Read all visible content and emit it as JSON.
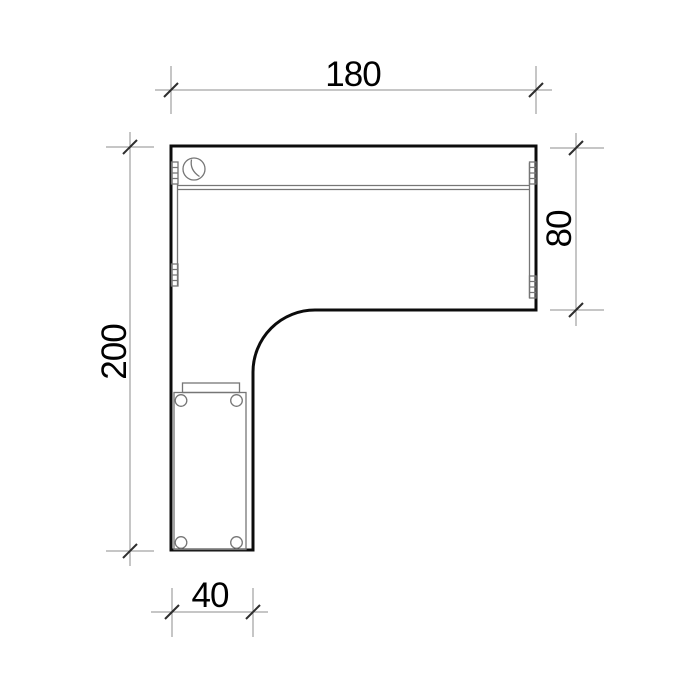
{
  "drawing": {
    "subject": "L-shaped corner desk, plan view technical drawing",
    "dimensions": {
      "top_width": {
        "value": "180"
      },
      "left_height": {
        "value": "200"
      },
      "right_depth": {
        "value": "80"
      },
      "bottom_width": {
        "value": "40"
      }
    },
    "colors": {
      "background": "#ffffff",
      "outline": "#0c0c0c",
      "detail_line": "#767676",
      "dimension_line": "#8e8e8e",
      "tick": "#2e2e2e",
      "text": "#000000"
    },
    "parts": [
      "desk-top-outline",
      "cable-grommet",
      "back-edge-double-line",
      "connector-left-top",
      "connector-left-bottom",
      "connector-right-top",
      "connector-right-bottom",
      "pedestal-body",
      "pedestal-handle",
      "pedestal-casters"
    ]
  }
}
